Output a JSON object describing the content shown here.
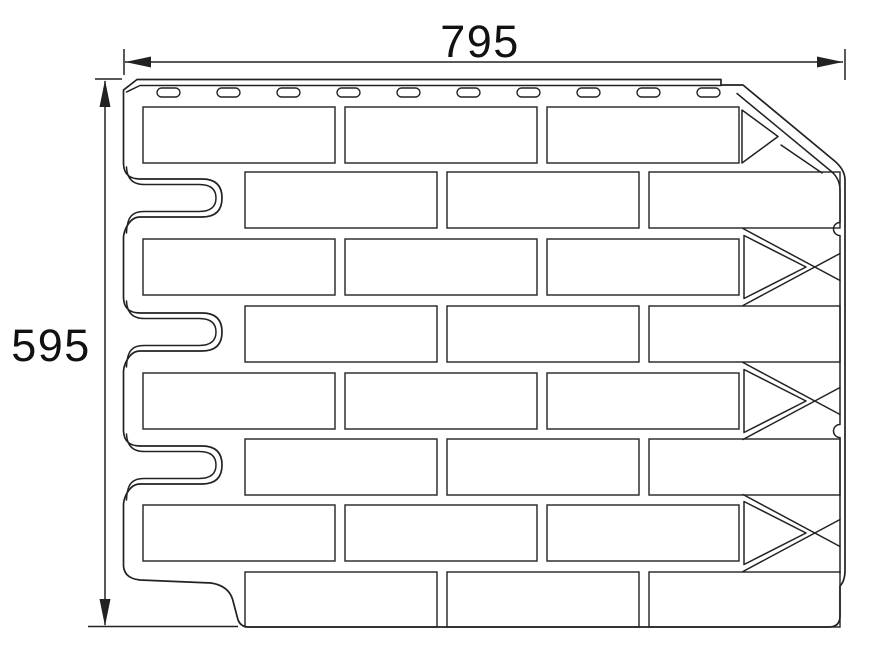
{
  "colors": {
    "background": "#ffffff",
    "line": "#222222",
    "text": "#111111"
  },
  "dimensions": {
    "width_label": "795",
    "height_label": "595"
  },
  "panel": {
    "brick_rows": 8,
    "bricks_per_row": 3,
    "nail_slots": 10,
    "left_tabs": 3,
    "right_arrow_interlocks": 3
  }
}
